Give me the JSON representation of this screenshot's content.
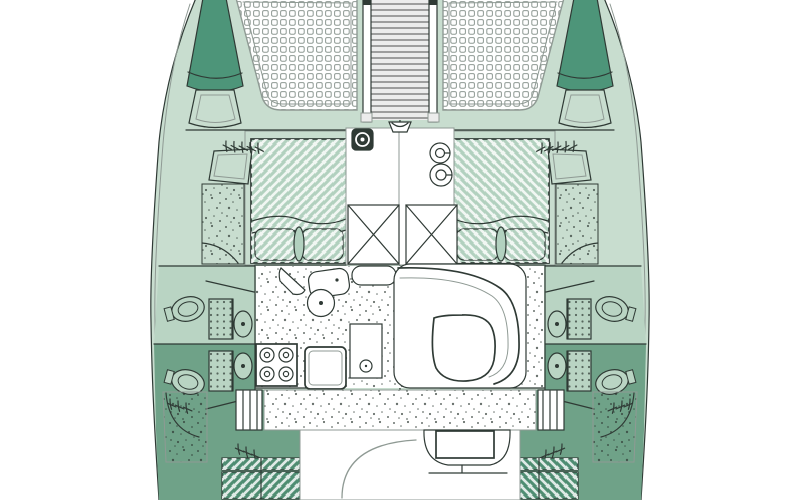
{
  "meta": {
    "title": "Catamaran deck layout plan",
    "view": "top-down floor plan, bow at top, symmetrical twin hulls"
  },
  "palette": {
    "deck_light": "#c8ddcf",
    "deck_shadow": "#6fa288",
    "hull_accent": "#4d9579",
    "head_upper": "#b9d4c3",
    "bed_fill": "#b2d1bf",
    "cushion_fill": "#4f8d72",
    "line_dark": "#2f3a35",
    "line_gray": "#8f9a94",
    "floor_white": "#ffffff",
    "walkway_bg": "#ececec",
    "rung_line": "#6f6f6f"
  },
  "features": {
    "trampolines": 2,
    "forward_double_berths": 2,
    "heads_compartments": 4,
    "shower_trays": 4,
    "stove_burners": 4,
    "deck_fill_fittings": 2,
    "crossed_deck_lockers": 2,
    "aft_cushion_benches": 2,
    "boarding_step_ladders": 2,
    "regions": [
      "port-bow",
      "starboard-bow",
      "port-trampoline",
      "starboard-trampoline",
      "mast-walkway",
      "anchor-windlass",
      "port-forward-berth",
      "starboard-forward-berth",
      "companionway",
      "port-heads",
      "starboard-heads",
      "galley",
      "dinette",
      "salon-floor",
      "aft-walkway",
      "cockpit",
      "helm-seat",
      "aft-cushions"
    ]
  }
}
